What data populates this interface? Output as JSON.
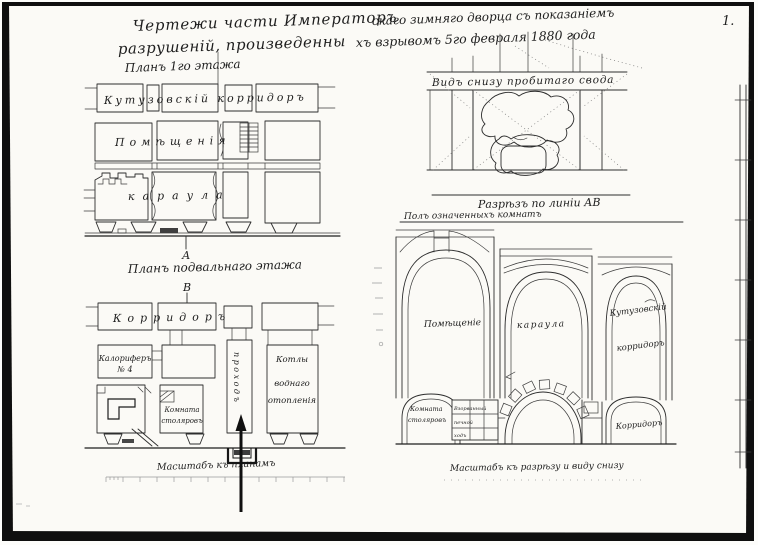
{
  "sheet": {
    "page_number": "1.",
    "title": {
      "line1_main": "Чертежи части Императоръ",
      "line1_cont": "скаго зимняго дворца съ показаніемъ",
      "line2_main": "разрушеній, произведенны",
      "line2_cont": "хъ взрывомъ 5го февраля 1880 года"
    }
  },
  "plan_first_floor": {
    "heading": "Планъ 1го этажа",
    "corridor": "Кутузовскій корридоръ",
    "rooms": "Помѣщенія",
    "guard": "караула",
    "marker_a": "А"
  },
  "plan_basement": {
    "heading": "Планъ подвальнаго этажа",
    "marker_b": "В",
    "corridor": "Корридоръ",
    "calorifer1": "Калориферъ",
    "calorifer2": "№ 4",
    "carpenters1": "Комната",
    "carpenters2": "столяровъ",
    "passage": "проходъ",
    "boilers1": "Котлы",
    "boilers2": "воднаго",
    "boilers3": "отопленія",
    "scale": "Масштабъ къ планамъ"
  },
  "vault_view": {
    "caption": "Видъ снизу пробитаго свода"
  },
  "section": {
    "heading": "Разрѣзъ по линіи АВ",
    "floor_note": "Полъ означенныхъ комнатъ",
    "bay1": "Помѣщеніе",
    "bay2": "караула",
    "bay3a": "Кутузовскій",
    "bay3b": "корридоръ",
    "cellar_left1": "Комната",
    "cellar_left2": "столяровъ",
    "blown1": "Взорванный",
    "blown2": "печной",
    "blown3": "ходъ",
    "cellar_right": "Корридоръ",
    "scale": "Масштабъ къ разрѣзу и виду снизу"
  }
}
